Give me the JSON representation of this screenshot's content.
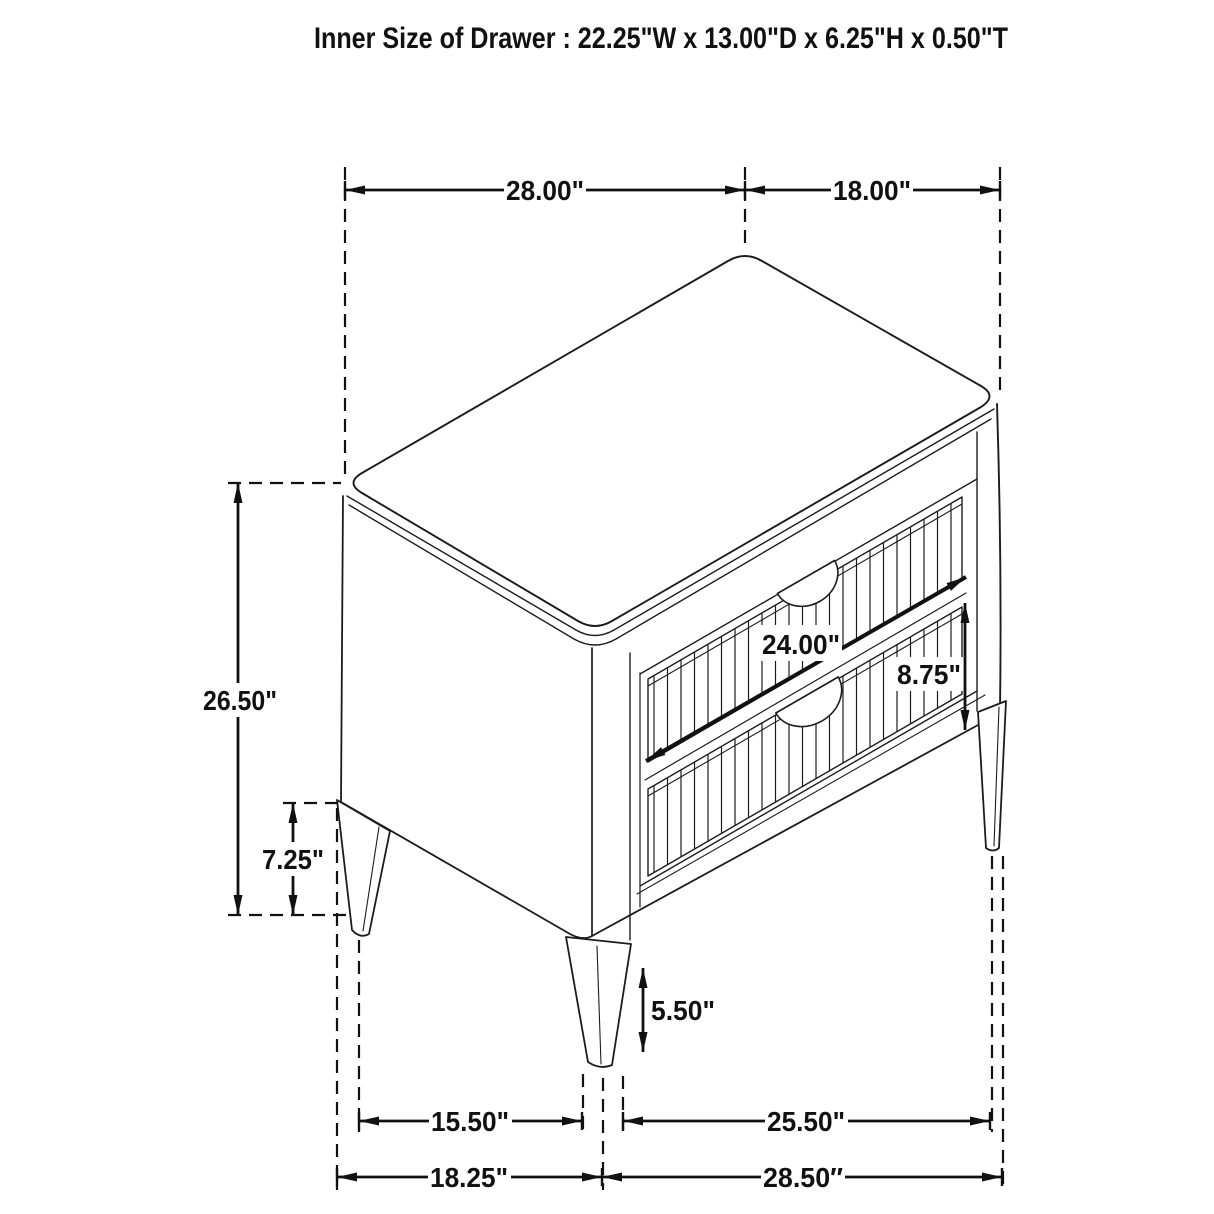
{
  "title": "Inner Size of Drawer : 22.25\"W x 13.00\"D x 6.25\"H x 0.50\"T",
  "dims": {
    "top_width": "28.00\"",
    "top_depth": "18.00\"",
    "overall_height": "26.50\"",
    "leg_clearance": "7.25\"",
    "drawer_front_width": "24.00\"",
    "drawer_front_height": "8.75\"",
    "leg_height": "5.50\"",
    "base_span_side": "15.50\"",
    "base_span_front": "25.50\"",
    "floor_depth": "18.25\"",
    "floor_width": "28.50″"
  },
  "line_color": "#1c1c1c",
  "dimension_color": "#111111",
  "background_color": "#ffffff"
}
